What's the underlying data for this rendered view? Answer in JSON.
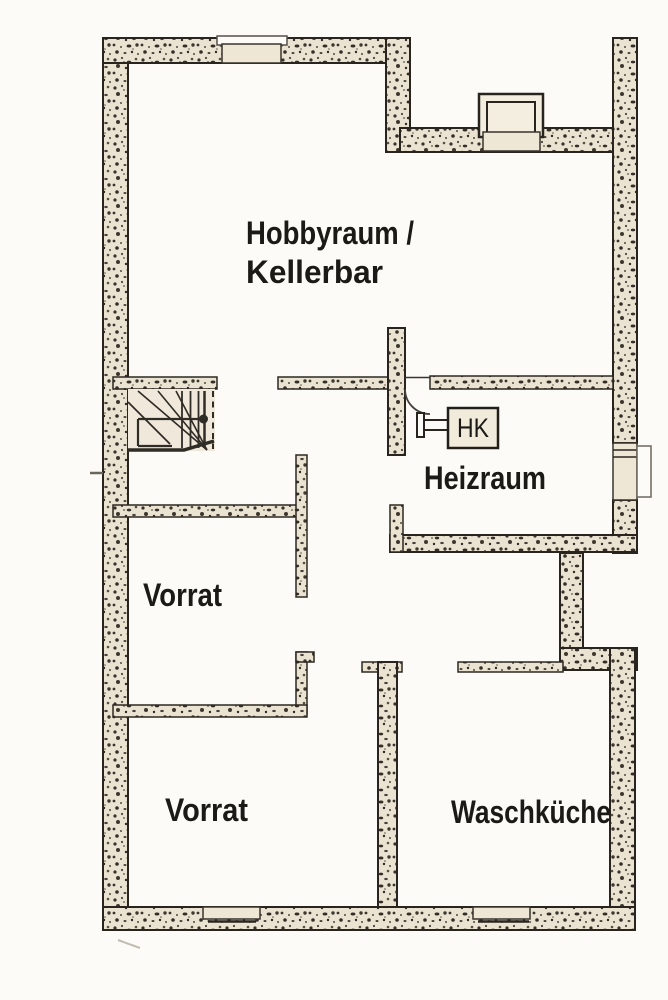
{
  "floorplan": {
    "type": "basement-floor-plan",
    "rooms": {
      "hobbyraum_kellerbar": {
        "label_line1": "Hobbyraum /",
        "label_line2": "Kellerbar"
      },
      "heizraum": {
        "label": "Heizraum"
      },
      "vorrat_upper": {
        "label": "Vorrat"
      },
      "vorrat_lower": {
        "label": "Vorrat"
      },
      "waschkueche": {
        "label": "Waschküche"
      }
    },
    "equipment": {
      "boiler": {
        "label": "HK"
      }
    },
    "colors": {
      "paper": "#fcfbf8",
      "wall_fill": "#eae3d2",
      "wall_outline": "#29241e",
      "window_fill": "#eee7d6",
      "stair_fill": "#f0e9db",
      "text": "#1c1a17"
    }
  }
}
